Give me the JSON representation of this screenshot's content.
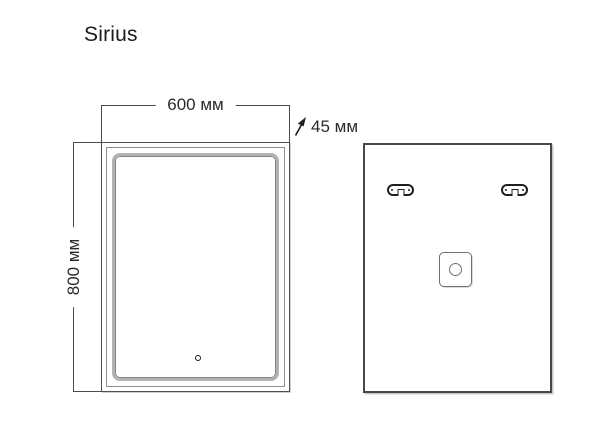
{
  "product": {
    "title": "Sirius"
  },
  "dimensions": {
    "width": "600 мм",
    "height": "800 мм",
    "depth": "45 мм"
  },
  "views": {
    "front": {
      "features": [
        "mirror-edge",
        "led-frame",
        "touch-sensor"
      ]
    },
    "back": {
      "features": [
        "mounting-bracket-left",
        "mounting-bracket-right",
        "junction-box",
        "cable-entry-hole"
      ]
    }
  },
  "colors": {
    "background": "#ffffff",
    "line": "#4a4a4a",
    "outline_dark": "#1f1f1f",
    "frame_light": "#b3b3b3",
    "frame_dark": "#858585",
    "text": "#1c1c1c"
  }
}
